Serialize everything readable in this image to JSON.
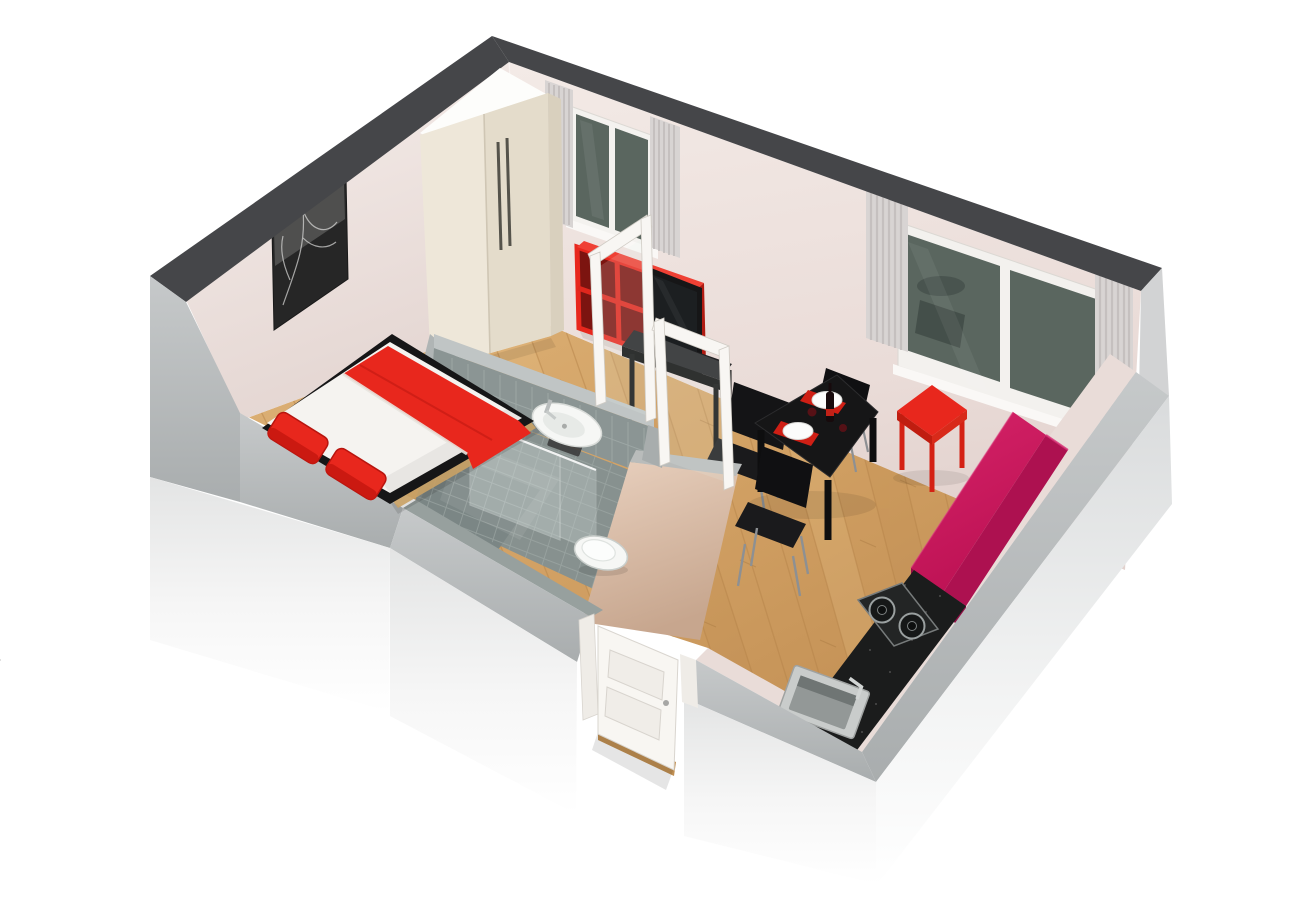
{
  "page": {
    "title": "3D Studio Apartment Floor Plan Render",
    "background": "#ffffff"
  },
  "scene": {
    "type": "3d-floor-plan",
    "view": "isometric-perspective",
    "style": "photoreal render",
    "text_visible": false
  },
  "colors": {
    "wall_top": "#454649",
    "wall_band_gray": "#b7babb",
    "wall_face_pink": "#f0e6e3",
    "wall_outer_white": "#f2f2f2",
    "floor_wood": "#d2a368",
    "plank_line": "#b5834a",
    "tile_gray": "#8b9594",
    "tile_dark": "#7b8685",
    "grout": "#a7b1af",
    "fixture_white": "#f6f7f5",
    "accent_red": "#e8271d",
    "accent_red_dark": "#b8150f",
    "sofa_magenta": "#cc1a5e",
    "sofa_magenta_dark": "#a81050",
    "black_furniture": "#161617",
    "counter_black": "#1b1c1c",
    "tan_wall": "#d9bfab",
    "curtain_gray": "#d8d4d3",
    "window_glass": "#5a665f",
    "wardrobe_cream": "#eee7d9",
    "door_white": "#f8f6f2"
  },
  "rooms": {
    "bedroom": {
      "name": "Bedroom",
      "items": {
        "bed": {
          "type": "double bed",
          "bedding": "white",
          "blanket_color": "red",
          "pillows": 2,
          "pillow_color": "red",
          "frame_color": "black"
        },
        "wardrobe": {
          "type": "two-door wardrobe",
          "color": "cream white",
          "handles": 2
        },
        "wall_art": {
          "type": "black and white picture",
          "count": 1
        }
      }
    },
    "bathroom": {
      "name": "Bathroom",
      "items": {
        "washbasin": {
          "color": "white",
          "faucet": "chrome"
        },
        "toilet": {
          "color": "white"
        },
        "shower": {
          "enclosure": "glass",
          "wall_tiles": "grey",
          "glass_frames": 2
        }
      }
    },
    "living_dining": {
      "name": "Living / Dining",
      "items": {
        "dining_table": {
          "color": "black",
          "seats": 2
        },
        "tableware": {
          "plates": 2,
          "placemats": 2,
          "placemat_color": "red",
          "wine_bottle": 1,
          "glasses": 2
        },
        "dining_chairs": {
          "count": 2,
          "color": "black",
          "legs": "metal"
        },
        "side_table": {
          "color": "red"
        },
        "sofa": {
          "color": "magenta"
        },
        "tv": {
          "type": "flat-screen",
          "color": "black"
        },
        "tv_desk": {
          "color": "black",
          "chair": "black"
        },
        "shelf_unit": {
          "color": "red",
          "cubes": 6,
          "rows": 2,
          "columns": 3
        }
      }
    },
    "kitchen": {
      "name": "Kitchenette",
      "items": {
        "counter": {
          "color": "black granite"
        },
        "cooktop": {
          "burners": 2
        },
        "sink": {
          "color": "stainless",
          "faucet": 1
        }
      }
    },
    "entry": {
      "name": "Entry",
      "items": {
        "door": {
          "color": "white",
          "state": "open",
          "panels": 2
        }
      }
    }
  },
  "windows": {
    "count": 2,
    "list": [
      {
        "id": "window-1",
        "wall": "back",
        "panes": 2,
        "curtains": 2,
        "curtain_color": "light grey"
      },
      {
        "id": "window-2",
        "wall": "right",
        "panes": 2,
        "curtains": 2,
        "curtain_color": "light grey"
      }
    ]
  },
  "floors": {
    "main": "light oak planks",
    "bathroom": "grey tiles"
  }
}
